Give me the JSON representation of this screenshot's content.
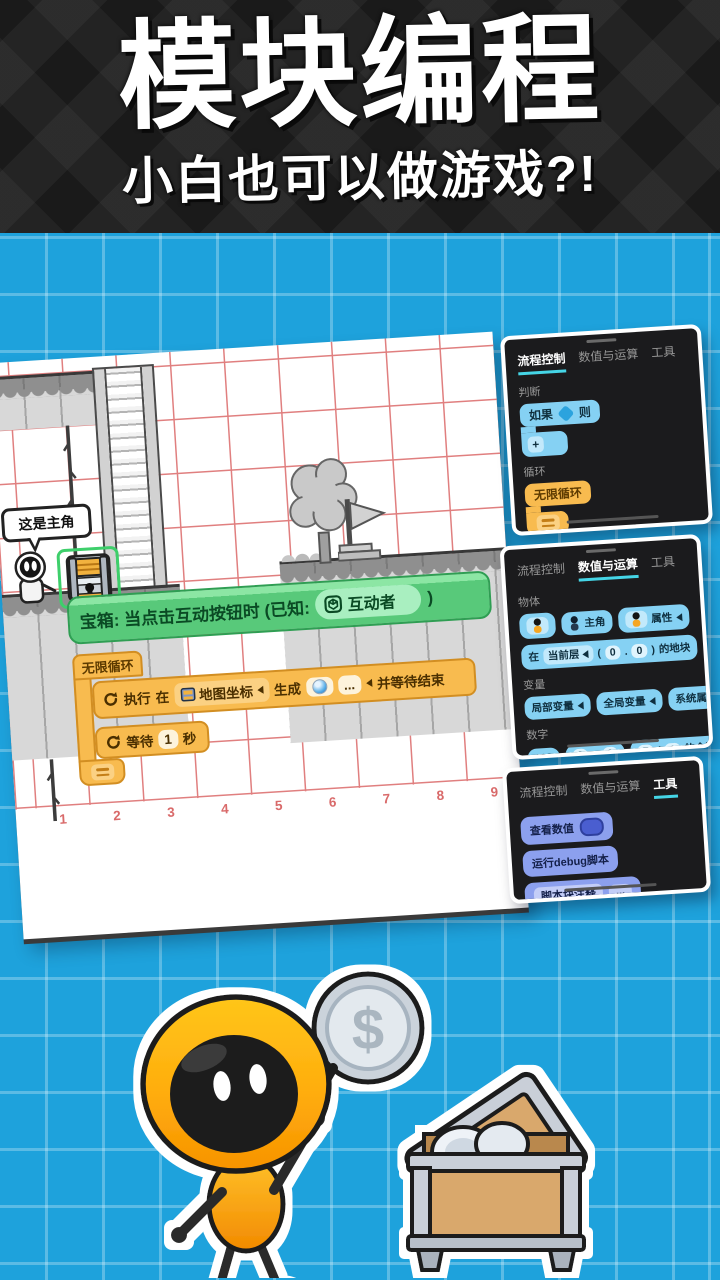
{
  "header": {
    "title": "模块编程",
    "subtitle": "小白也可以做游戏?!"
  },
  "editor": {
    "speech_bubble": "这是主角",
    "axis": [
      "1",
      "2",
      "3",
      "4",
      "5",
      "6",
      "7",
      "8",
      "9"
    ],
    "event": {
      "prefix": "宝箱: 当点击互动按钮时 (已知:",
      "pill": "互动者",
      "close": ")"
    },
    "loop": {
      "head": "无限循环",
      "cmd1": {
        "t1": "执行",
        "t2": "在",
        "map": "地图坐标",
        "t3": "生成",
        "dots": "...",
        "t4": "并等待结束"
      },
      "cmd2": {
        "t1": "等待",
        "v": "1",
        "t2": "秒"
      }
    }
  },
  "panels": [
    {
      "tabs": [
        "流程控制",
        "数值与运算",
        "工具"
      ],
      "sections": [
        {
          "label": "判断",
          "if_t1": "如果",
          "if_t2": "则",
          "plus": "+"
        },
        {
          "label": "循环",
          "forever": "无限循环",
          "repeat_t1": "循环",
          "repeat_v": "10",
          "repeat_t2": "次"
        }
      ]
    },
    {
      "tabs": [
        "流程控制",
        "数值与运算",
        "工具"
      ],
      "sections": [
        {
          "label": "物体",
          "hero": "主角",
          "attr": "属性",
          "at_t1": "在",
          "at_layer": "当前层",
          "open": "(",
          "x": "0",
          "dot": ".",
          "y": "0",
          "close": ")",
          "at_t2": "的地块"
        },
        {
          "label": "变量",
          "local": "局部变量",
          "global": "全局变量",
          "system": "系统属性"
        },
        {
          "label": "数字",
          "n": "123",
          "a": "2",
          "plus": "+",
          "b": "3",
          "c": "7",
          "slash": "/",
          "d": "3",
          "rem": "的余数",
          "sin": "sin",
          "angle": "90",
          "num": "2.5",
          "attr2": "属性"
        }
      ]
    },
    {
      "tabs": [
        "流程控制",
        "数值与运算",
        "工具"
      ],
      "blocks": {
        "view": "查看数值",
        "debug": "运行debug脚本",
        "comment": "脚本块注释",
        "dots": "..."
      }
    }
  ],
  "illustration": {
    "dollar": "$"
  },
  "colors": {
    "background_blue": "#1EA2DC",
    "grid_line_blue": "#5FC3EA",
    "header_dark": "#242424",
    "canvas_grid_red": "#E07F7F",
    "axis_red": "#D96A6A",
    "panel_dark": "#1B1B1D",
    "tab_underline_cyan": "#45D5E6",
    "block_blue": "#85D1F3",
    "block_blue_deep": "#2BA3DE",
    "block_orange": "#F8BB4F",
    "block_orange_deep": "#D28E22",
    "block_green": "#58C97A",
    "block_green_deep": "#2F9E53",
    "block_periwinkle": "#8CA0EE",
    "selection_green": "#3ECF6B",
    "mascot_orange": "#FFAD0D"
  }
}
